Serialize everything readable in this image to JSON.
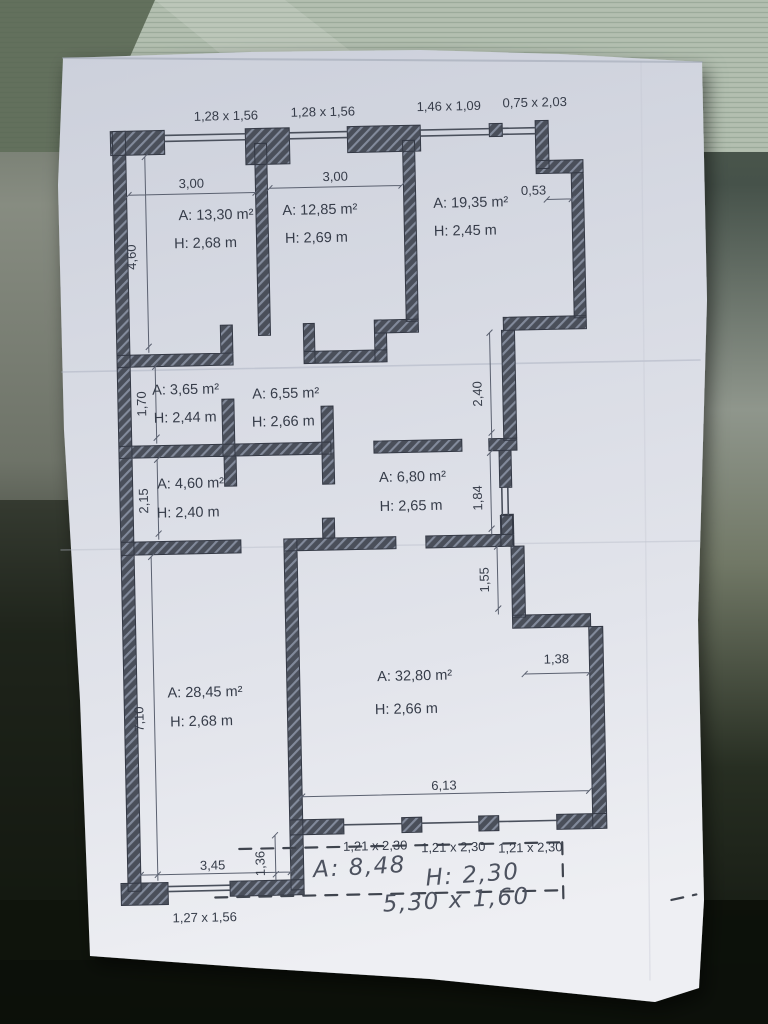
{
  "plan": {
    "top_window_labels": [
      "1,28 x 1,56",
      "1,28 x 1,56",
      "1,46 x 1,09",
      "0,75 x 2,03"
    ],
    "rooms": [
      {
        "area": "A: 13,30 m²",
        "ceiling": "H: 2,68 m"
      },
      {
        "area": "A: 12,85 m²",
        "ceiling": "H: 2,69 m"
      },
      {
        "area": "A: 19,35 m²",
        "ceiling": "H: 2,45 m"
      },
      {
        "area": "A: 3,65 m²",
        "ceiling": "H: 2,44 m"
      },
      {
        "area": "A: 6,55 m²",
        "ceiling": "H: 2,66 m"
      },
      {
        "area": "A: 4,60 m²",
        "ceiling": "H: 2,40 m"
      },
      {
        "area": "A: 6,80 m²",
        "ceiling": "H: 2,65 m"
      },
      {
        "area": "A: 28,45 m²",
        "ceiling": "H: 2,68 m"
      },
      {
        "area": "A: 32,80 m²",
        "ceiling": "H: 2,66 m"
      }
    ],
    "dimensions": {
      "room1_width": "3,00",
      "room2_width": "3,00",
      "notch": "0,53",
      "left_top": "4,60",
      "left_mid1": "1,70",
      "left_mid2": "2,15",
      "left_bottom": "7,10",
      "right_top": "2,40",
      "right_mid1": "1,84",
      "right_mid2": "1,55",
      "step_width": "1,38",
      "living_width": "6,13",
      "bottom_left_width": "3,45",
      "corner_offset": "1,36"
    },
    "balcony_door_labels": [
      "1,21 x 2,30",
      "1,21 x 2,30",
      "1,21 x 2,30"
    ],
    "bottom_window_label": "1,27 x 1,56",
    "handwriting": {
      "area": "A: 8,48",
      "height": "H: 2,30",
      "dimensions": "5,30 x 1,60"
    }
  },
  "colors": {
    "wall": "#4a4f5a",
    "wall_hatch": "#828a9b",
    "paper": "#dcdee6",
    "ink": "#363c49",
    "pencil": "#4d525f",
    "background_fabric": "#b3bfb0",
    "background_dark": "#0b0f09"
  }
}
